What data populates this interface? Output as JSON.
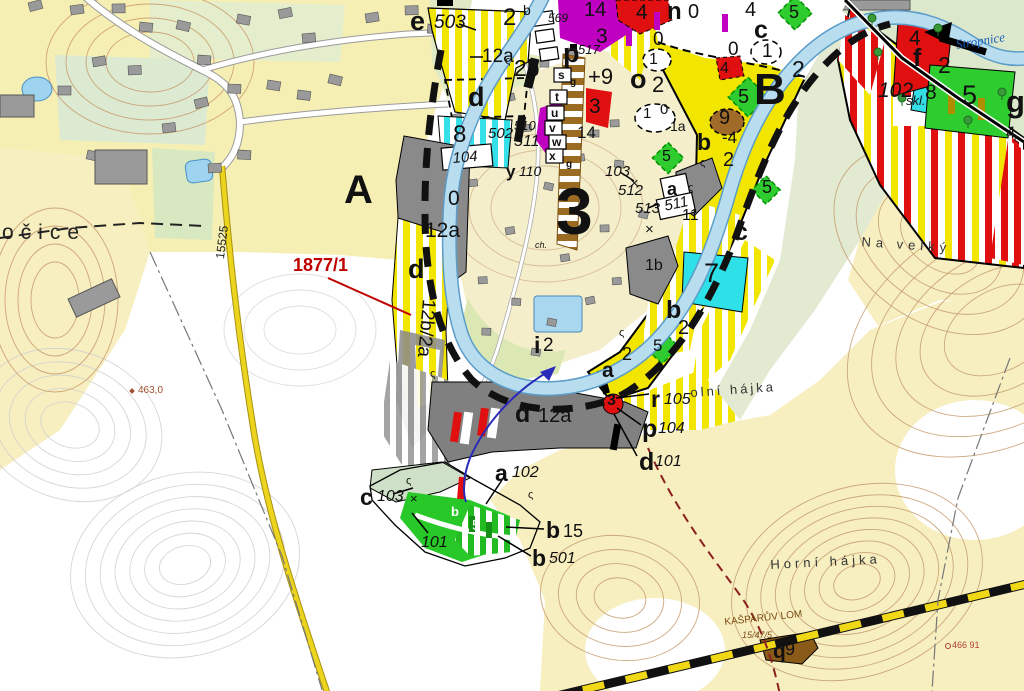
{
  "map": {
    "type": "zoning-plan-over-topographic-base",
    "zones_visible": [
      "A",
      "B",
      "3"
    ],
    "river_name": "Stropnice",
    "road_number": "15525",
    "highlighted_parcel": "1877/1"
  },
  "colors": {
    "zone_yellow": "#f2e500",
    "zone_cyan": "#35e0e8",
    "zone_green": "#2ecc2e",
    "zone_purple": "#c000c0",
    "zone_red": "#e01010",
    "zone_gray": "#8a8a8a",
    "zone_brown": "#a06a28",
    "river": "#b8ddef",
    "terrain_cream": "#f7efc0",
    "contour_brown": "#c49a6c",
    "parcel_label_red": "#c00000",
    "water_label_blue": "#1b5eb5"
  },
  "labels": [
    {
      "t": "e",
      "x": 410,
      "y": 8,
      "s": 27,
      "b": 1,
      "n": "code-e"
    },
    {
      "t": "503",
      "x": 434,
      "y": 13,
      "s": 19,
      "i": 1,
      "n": "parcel-503"
    },
    {
      "t": "2",
      "x": 503,
      "y": 6,
      "s": 24
    },
    {
      "t": "b",
      "x": 523,
      "y": 3,
      "s": 14
    },
    {
      "t": "569",
      "x": 548,
      "y": 12,
      "s": 12,
      "i": 1
    },
    {
      "t": "12a",
      "x": 482,
      "y": 47,
      "s": 19
    },
    {
      "t": "2b",
      "x": 514,
      "y": 57,
      "s": 23
    },
    {
      "t": "d",
      "x": 468,
      "y": 84,
      "s": 27,
      "b": 1
    },
    {
      "t": "8",
      "x": 453,
      "y": 123,
      "s": 24
    },
    {
      "t": "502",
      "x": 488,
      "y": 126,
      "s": 15,
      "i": 1
    },
    {
      "t": "510",
      "x": 514,
      "y": 119,
      "s": 13,
      "i": 1
    },
    {
      "t": "511",
      "x": 514,
      "y": 134,
      "s": 16,
      "i": 1
    },
    {
      "t": "104",
      "x": 452,
      "y": 151,
      "s": 15,
      "i": 1,
      "r": -5
    },
    {
      "t": "y",
      "x": 506,
      "y": 163,
      "s": 17,
      "b": 1
    },
    {
      "t": "110",
      "x": 519,
      "y": 164,
      "s": 14,
      "i": 1
    },
    {
      "t": "p",
      "x": 563,
      "y": 40,
      "s": 27,
      "b": 1
    },
    {
      "t": "517",
      "x": 578,
      "y": 43,
      "s": 13,
      "i": 1
    },
    {
      "t": "s",
      "x": 558,
      "y": 69,
      "s": 12,
      "b": 1
    },
    {
      "t": "t",
      "x": 555,
      "y": 91,
      "s": 12,
      "b": 1
    },
    {
      "t": "u",
      "x": 551,
      "y": 107,
      "s": 12,
      "b": 1
    },
    {
      "t": "v",
      "x": 549,
      "y": 122,
      "s": 12,
      "b": 1
    },
    {
      "t": "w",
      "x": 552,
      "y": 136,
      "s": 12,
      "b": 1
    },
    {
      "t": "x",
      "x": 549,
      "y": 150,
      "s": 12,
      "b": 1
    },
    {
      "t": "g",
      "x": 570,
      "y": 78,
      "s": 10,
      "b": 1
    },
    {
      "t": "g",
      "x": 566,
      "y": 160,
      "s": 10,
      "b": 1
    },
    {
      "t": "14",
      "x": 584,
      "y": 0,
      "s": 20
    },
    {
      "t": "4",
      "x": 636,
      "y": 2,
      "s": 21
    },
    {
      "t": "3",
      "x": 596,
      "y": 26,
      "s": 21
    },
    {
      "t": "3",
      "x": 589,
      "y": 96,
      "s": 21
    },
    {
      "t": "14",
      "x": 577,
      "y": 124,
      "s": 17
    },
    {
      "t": "n",
      "x": 667,
      "y": 0,
      "s": 24,
      "b": 1
    },
    {
      "t": "0",
      "x": 688,
      "y": 2,
      "s": 20
    },
    {
      "t": "0",
      "x": 653,
      "y": 30,
      "s": 19
    },
    {
      "t": "1",
      "x": 649,
      "y": 52,
      "s": 16
    },
    {
      "t": "o",
      "x": 630,
      "y": 66,
      "s": 27,
      "b": 1
    },
    {
      "t": "2",
      "x": 652,
      "y": 74,
      "s": 22
    },
    {
      "t": "+9",
      "x": 588,
      "y": 66,
      "s": 22
    },
    {
      "t": "1",
      "x": 643,
      "y": 106,
      "s": 15
    },
    {
      "t": "0",
      "x": 660,
      "y": 102,
      "s": 15
    },
    {
      "t": "1a",
      "x": 670,
      "y": 119,
      "s": 14
    },
    {
      "t": "5",
      "x": 662,
      "y": 149,
      "s": 16
    },
    {
      "t": "4",
      "x": 745,
      "y": 0,
      "s": 20
    },
    {
      "t": "5",
      "x": 789,
      "y": 3,
      "s": 18
    },
    {
      "t": "c",
      "x": 754,
      "y": 18,
      "s": 25,
      "b": 1
    },
    {
      "t": "0",
      "x": 728,
      "y": 40,
      "s": 19
    },
    {
      "t": "1",
      "x": 762,
      "y": 42,
      "s": 19
    },
    {
      "t": "4",
      "x": 720,
      "y": 61,
      "s": 16
    },
    {
      "t": "2",
      "x": 792,
      "y": 58,
      "s": 23
    },
    {
      "t": "B",
      "x": 754,
      "y": 68,
      "s": 44,
      "b": 1,
      "n": "zone-b"
    },
    {
      "t": "5",
      "x": 738,
      "y": 87,
      "s": 20
    },
    {
      "t": "9",
      "x": 719,
      "y": 108,
      "s": 20
    },
    {
      "t": "b",
      "x": 697,
      "y": 131,
      "s": 23,
      "b": 1
    },
    {
      "t": "-4",
      "x": 722,
      "y": 129,
      "s": 17
    },
    {
      "t": "2",
      "x": 723,
      "y": 150,
      "s": 20
    },
    {
      "t": "5",
      "x": 762,
      "y": 178,
      "s": 18
    },
    {
      "t": "102",
      "x": 878,
      "y": 80,
      "s": 21,
      "i": 1
    },
    {
      "t": "skl.",
      "x": 906,
      "y": 94,
      "s": 13,
      "i": 1
    },
    {
      "t": "4",
      "x": 909,
      "y": 28,
      "s": 21
    },
    {
      "t": "f",
      "x": 913,
      "y": 46,
      "s": 25,
      "b": 1
    },
    {
      "t": "2",
      "x": 938,
      "y": 54,
      "s": 23
    },
    {
      "t": "8",
      "x": 925,
      "y": 82,
      "s": 21
    },
    {
      "t": "5",
      "x": 962,
      "y": 82,
      "s": 27
    },
    {
      "t": "g",
      "x": 1006,
      "y": 86,
      "s": 31,
      "b": 1
    },
    {
      "t": "4",
      "x": 1006,
      "y": 124,
      "s": 17
    },
    {
      "t": "Stropnice",
      "x": 955,
      "y": 38,
      "s": 13,
      "i": 1,
      "f": "serif",
      "c": "#1b5eb5",
      "r": -9,
      "n": "river-name"
    },
    {
      "t": "A",
      "x": 344,
      "y": 170,
      "s": 40,
      "b": 1,
      "n": "zone-a"
    },
    {
      "t": "1877/1",
      "x": 293,
      "y": 256,
      "s": 18,
      "b": 1,
      "c": "#c00000",
      "n": "parcel-number-1877-1"
    },
    {
      "t": "15525",
      "x": 214,
      "y": 258,
      "s": 12,
      "r": -83,
      "c": "#222",
      "n": "road-number"
    },
    {
      "t": "463,0",
      "x": 138,
      "y": 386,
      "s": 10,
      "c": "#a05030",
      "n": "elevation-point"
    },
    {
      "t": "očice",
      "x": 2,
      "y": 222,
      "s": 21,
      "ls": 7,
      "c": "#222",
      "n": "village-name"
    },
    {
      "t": "0",
      "x": 448,
      "y": 188,
      "s": 21
    },
    {
      "t": "12a",
      "x": 425,
      "y": 220,
      "s": 21
    },
    {
      "t": "d",
      "x": 408,
      "y": 256,
      "s": 27,
      "b": 1
    },
    {
      "t": "12b/2a",
      "x": 438,
      "y": 300,
      "s": 19,
      "r": 95
    },
    {
      "t": "3",
      "x": 556,
      "y": 178,
      "s": 66,
      "b": 1,
      "n": "zone-3"
    },
    {
      "t": "ch.",
      "x": 535,
      "y": 241,
      "s": 9,
      "i": 1
    },
    {
      "t": "103",
      "x": 605,
      "y": 164,
      "s": 15,
      "i": 1
    },
    {
      "t": "512",
      "x": 618,
      "y": 183,
      "s": 15,
      "i": 1
    },
    {
      "t": "513",
      "x": 635,
      "y": 201,
      "s": 15,
      "i": 1
    },
    {
      "t": "511",
      "x": 663,
      "y": 199,
      "s": 15,
      "i": 1,
      "r": -12
    },
    {
      "t": "a",
      "x": 667,
      "y": 180,
      "s": 18,
      "b": 1
    },
    {
      "t": "11",
      "x": 682,
      "y": 208,
      "s": 16
    },
    {
      "t": "1b",
      "x": 645,
      "y": 258,
      "s": 16
    },
    {
      "t": "c",
      "x": 734,
      "y": 220,
      "s": 25,
      "b": 1
    },
    {
      "t": "7",
      "x": 704,
      "y": 260,
      "s": 27
    },
    {
      "t": "b",
      "x": 666,
      "y": 298,
      "s": 25,
      "b": 1
    },
    {
      "t": "2",
      "x": 678,
      "y": 318,
      "s": 20
    },
    {
      "t": "5",
      "x": 653,
      "y": 337,
      "s": 17
    },
    {
      "t": "2",
      "x": 622,
      "y": 345,
      "s": 18
    },
    {
      "t": "a",
      "x": 602,
      "y": 360,
      "s": 21,
      "b": 1
    },
    {
      "t": "i",
      "x": 534,
      "y": 334,
      "s": 23,
      "b": 1
    },
    {
      "t": "2",
      "x": 543,
      "y": 336,
      "s": 19
    },
    {
      "t": "d",
      "x": 515,
      "y": 402,
      "s": 25,
      "b": 1
    },
    {
      "t": "12a",
      "x": 538,
      "y": 406,
      "s": 20
    },
    {
      "t": "3",
      "x": 607,
      "y": 393,
      "s": 16,
      "b": 1
    },
    {
      "t": "r",
      "x": 651,
      "y": 388,
      "s": 23,
      "b": 1
    },
    {
      "t": "105",
      "x": 664,
      "y": 392,
      "s": 16,
      "i": 1
    },
    {
      "t": "p",
      "x": 642,
      "y": 417,
      "s": 25,
      "b": 1
    },
    {
      "t": "104",
      "x": 658,
      "y": 421,
      "s": 16,
      "i": 1
    },
    {
      "t": "d",
      "x": 639,
      "y": 450,
      "s": 25,
      "b": 1
    },
    {
      "t": "101",
      "x": 655,
      "y": 454,
      "s": 16,
      "i": 1
    },
    {
      "t": "a",
      "x": 495,
      "y": 462,
      "s": 23,
      "b": 1
    },
    {
      "t": "102",
      "x": 512,
      "y": 465,
      "s": 16,
      "i": 1
    },
    {
      "t": "c",
      "x": 360,
      "y": 486,
      "s": 23,
      "b": 1
    },
    {
      "t": "103",
      "x": 377,
      "y": 489,
      "s": 16,
      "i": 1
    },
    {
      "t": "101",
      "x": 421,
      "y": 535,
      "s": 16,
      "i": 1
    },
    {
      "t": "b",
      "x": 546,
      "y": 519,
      "s": 23,
      "b": 1
    },
    {
      "t": "15",
      "x": 563,
      "y": 522,
      "s": 18
    },
    {
      "t": "b",
      "x": 532,
      "y": 547,
      "s": 23,
      "b": 1
    },
    {
      "t": "501",
      "x": 549,
      "y": 551,
      "s": 16,
      "i": 1
    },
    {
      "t": "b",
      "x": 451,
      "y": 505,
      "s": 13,
      "b": 1,
      "c": "#fff"
    },
    {
      "t": "5",
      "x": 472,
      "y": 518,
      "s": 15,
      "c": "#fff"
    },
    {
      "t": "Na velký",
      "x": 862,
      "y": 235,
      "s": 13,
      "ls": 5,
      "c": "#333",
      "r": 4,
      "n": "place-name-na-velky"
    },
    {
      "t": "olní hájka",
      "x": 690,
      "y": 386,
      "s": 13,
      "ls": 3,
      "c": "#333",
      "r": -4,
      "n": "place-name-dolni-hajka"
    },
    {
      "t": "Horní hájka",
      "x": 770,
      "y": 558,
      "s": 13,
      "ls": 4,
      "c": "#333",
      "r": -3,
      "n": "place-name-horni-hajka"
    },
    {
      "t": "KAŠPARŮV LOM",
      "x": 724,
      "y": 618,
      "s": 10,
      "c": "#7a4a14",
      "r": -6,
      "n": "quarry-name"
    },
    {
      "t": "15/47/5",
      "x": 742,
      "y": 631,
      "s": 9,
      "i": 1,
      "c": "#7a4a14"
    },
    {
      "t": "q",
      "x": 773,
      "y": 641,
      "s": 21,
      "b": 1
    },
    {
      "t": "9",
      "x": 785,
      "y": 640,
      "s": 18
    },
    {
      "t": "466 91",
      "x": 952,
      "y": 641,
      "s": 9,
      "c": "#b04030",
      "n": "benchmark"
    },
    {
      "t": "ς",
      "x": 505,
      "y": 56,
      "s": 11
    },
    {
      "t": "ς",
      "x": 619,
      "y": 328,
      "s": 11
    },
    {
      "t": "ς",
      "x": 688,
      "y": 183,
      "s": 11
    },
    {
      "t": "ς",
      "x": 430,
      "y": 369,
      "s": 11
    },
    {
      "t": "ς",
      "x": 406,
      "y": 476,
      "s": 11
    },
    {
      "t": "ς",
      "x": 528,
      "y": 490,
      "s": 11
    },
    {
      "t": "ς",
      "x": 1014,
      "y": 134,
      "s": 11
    },
    {
      "t": "ς",
      "x": 700,
      "y": 158,
      "s": 11
    },
    {
      "t": "×",
      "x": 630,
      "y": 176,
      "s": 15
    },
    {
      "t": "×",
      "x": 645,
      "y": 222,
      "s": 15
    },
    {
      "t": "×",
      "x": 410,
      "y": 492,
      "s": 13
    }
  ]
}
